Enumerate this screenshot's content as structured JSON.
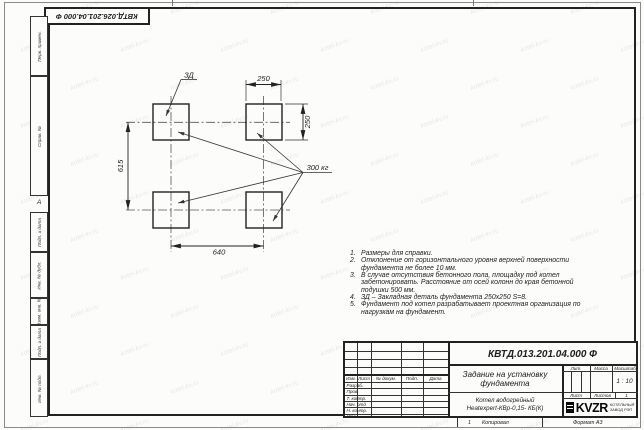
{
  "watermark": {
    "text": "kotel-kv.ru"
  },
  "sheet": {
    "top_designation": "КВТД.026.201.04.000 Ф",
    "center_mark": "А",
    "margin_columns": [
      "Перв. примен.",
      "Справ. №",
      "Подп. и дата",
      "Инв. № дубл.",
      "Взам. инв. №",
      "Подп. и дата",
      "Инв. № подл."
    ]
  },
  "drawing": {
    "embed_label": "ЗД",
    "dim_top": "250",
    "dim_right": "250",
    "dim_left": "615",
    "dim_bottom": "640",
    "load_label": "300 кг"
  },
  "notes": {
    "lines": [
      {
        "n": "1.",
        "t": "Размеры для справки."
      },
      {
        "n": "2.",
        "t": "Отклонение от горизонтального уровня верхней поверхности"
      },
      {
        "n": "",
        "t": "фундамента не более 10 мм."
      },
      {
        "n": "3.",
        "t": "В случае отсутствия бетонного пола, площадку под котел"
      },
      {
        "n": "",
        "t": "забетонировать. Расстояние от осей колонн до края бетонной"
      },
      {
        "n": "",
        "t": "подушки 500 мм."
      },
      {
        "n": "4.",
        "t": "ЗД – Закладная деталь фундамента 250х250 S=8."
      },
      {
        "n": "5.",
        "t": "Фундамент под котел разрабатывает проектная организация по"
      },
      {
        "n": "",
        "t": "нагрузкам на фундамент."
      }
    ]
  },
  "title_block": {
    "designation": "КВТД.013.201.04.000 Ф",
    "title_line1": "Задание на установку",
    "title_line2": "фундамента",
    "product_line1": "Котел водогрейный",
    "product_line2": "Heatexpert-КВр-0,15- КБ(К)",
    "scale_value": "1 : 10",
    "headers": {
      "lit": "Лит.",
      "massa": "Масса",
      "masshtab": "Масштаб",
      "list": "Лист",
      "listov": "Листов",
      "listov_value": "1"
    },
    "columns": {
      "izm": "Изм.",
      "list": "Лист",
      "n_dokum": "№ докум.",
      "podp": "Подп.",
      "data": "Дата"
    },
    "rows": [
      "Разраб.",
      "Пров.",
      "Т. контр.",
      "Нач. отд",
      "Н. контр.",
      "Утв."
    ],
    "logo": {
      "text": "KVZR",
      "sub_line1": "КОТЕЛЬНЫЙ",
      "sub_line2": "ЗАВОД РЭП"
    }
  },
  "footer": {
    "num": "1",
    "kopiroval": "Копировал",
    "format": "Формат А3"
  }
}
